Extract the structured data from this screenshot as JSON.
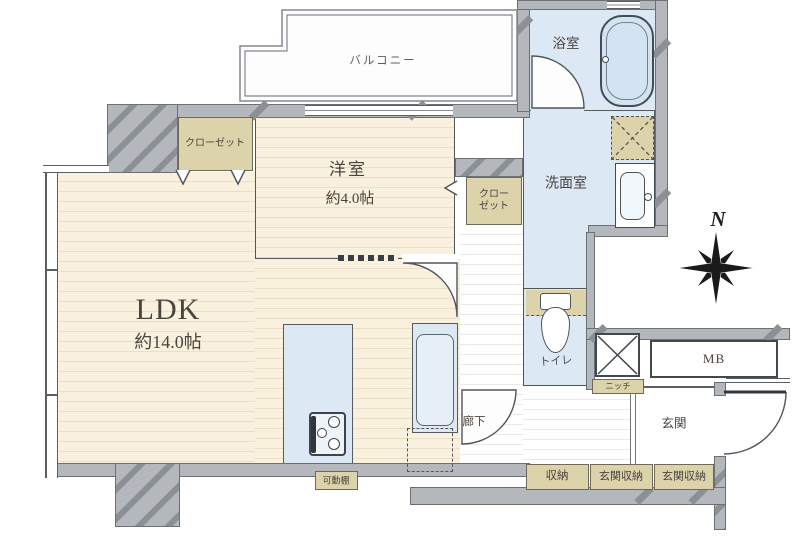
{
  "floor_plan": {
    "rooms": {
      "balcony": {
        "label": "バルコニー"
      },
      "western_room": {
        "label": "洋室",
        "area": "約4.0帖"
      },
      "ldk": {
        "label": "LDK",
        "area": "約14.0帖"
      },
      "bathroom": {
        "label": "浴室"
      },
      "washroom": {
        "label": "洗面室"
      },
      "toilet": {
        "label": "トイレ"
      },
      "hallway": {
        "label": "廊下"
      },
      "entrance": {
        "label": "玄関"
      }
    },
    "storage": {
      "closet_top": {
        "label": "クローゼット"
      },
      "closet_mid": {
        "line1": "クロー",
        "line2": "ゼット"
      },
      "shuno": {
        "label": "収納"
      },
      "entrance_storage_left": {
        "label": "玄関収納"
      },
      "entrance_storage_right": {
        "label": "玄関収納"
      },
      "niche": {
        "label": "ニッチ"
      },
      "movable_shelf": {
        "label": "可動棚"
      }
    },
    "other": {
      "meter_box": {
        "label": "MB"
      },
      "compass": {
        "label": "N"
      }
    },
    "colors": {
      "wall_gray": "#b4b8bc",
      "wall_outline": "#6b7075",
      "wood_floor": "#f9f0dd",
      "water_area_blue": "#dce8f4",
      "storage_tan": "#ddd3ab",
      "label_ink": "#4a443e"
    }
  }
}
